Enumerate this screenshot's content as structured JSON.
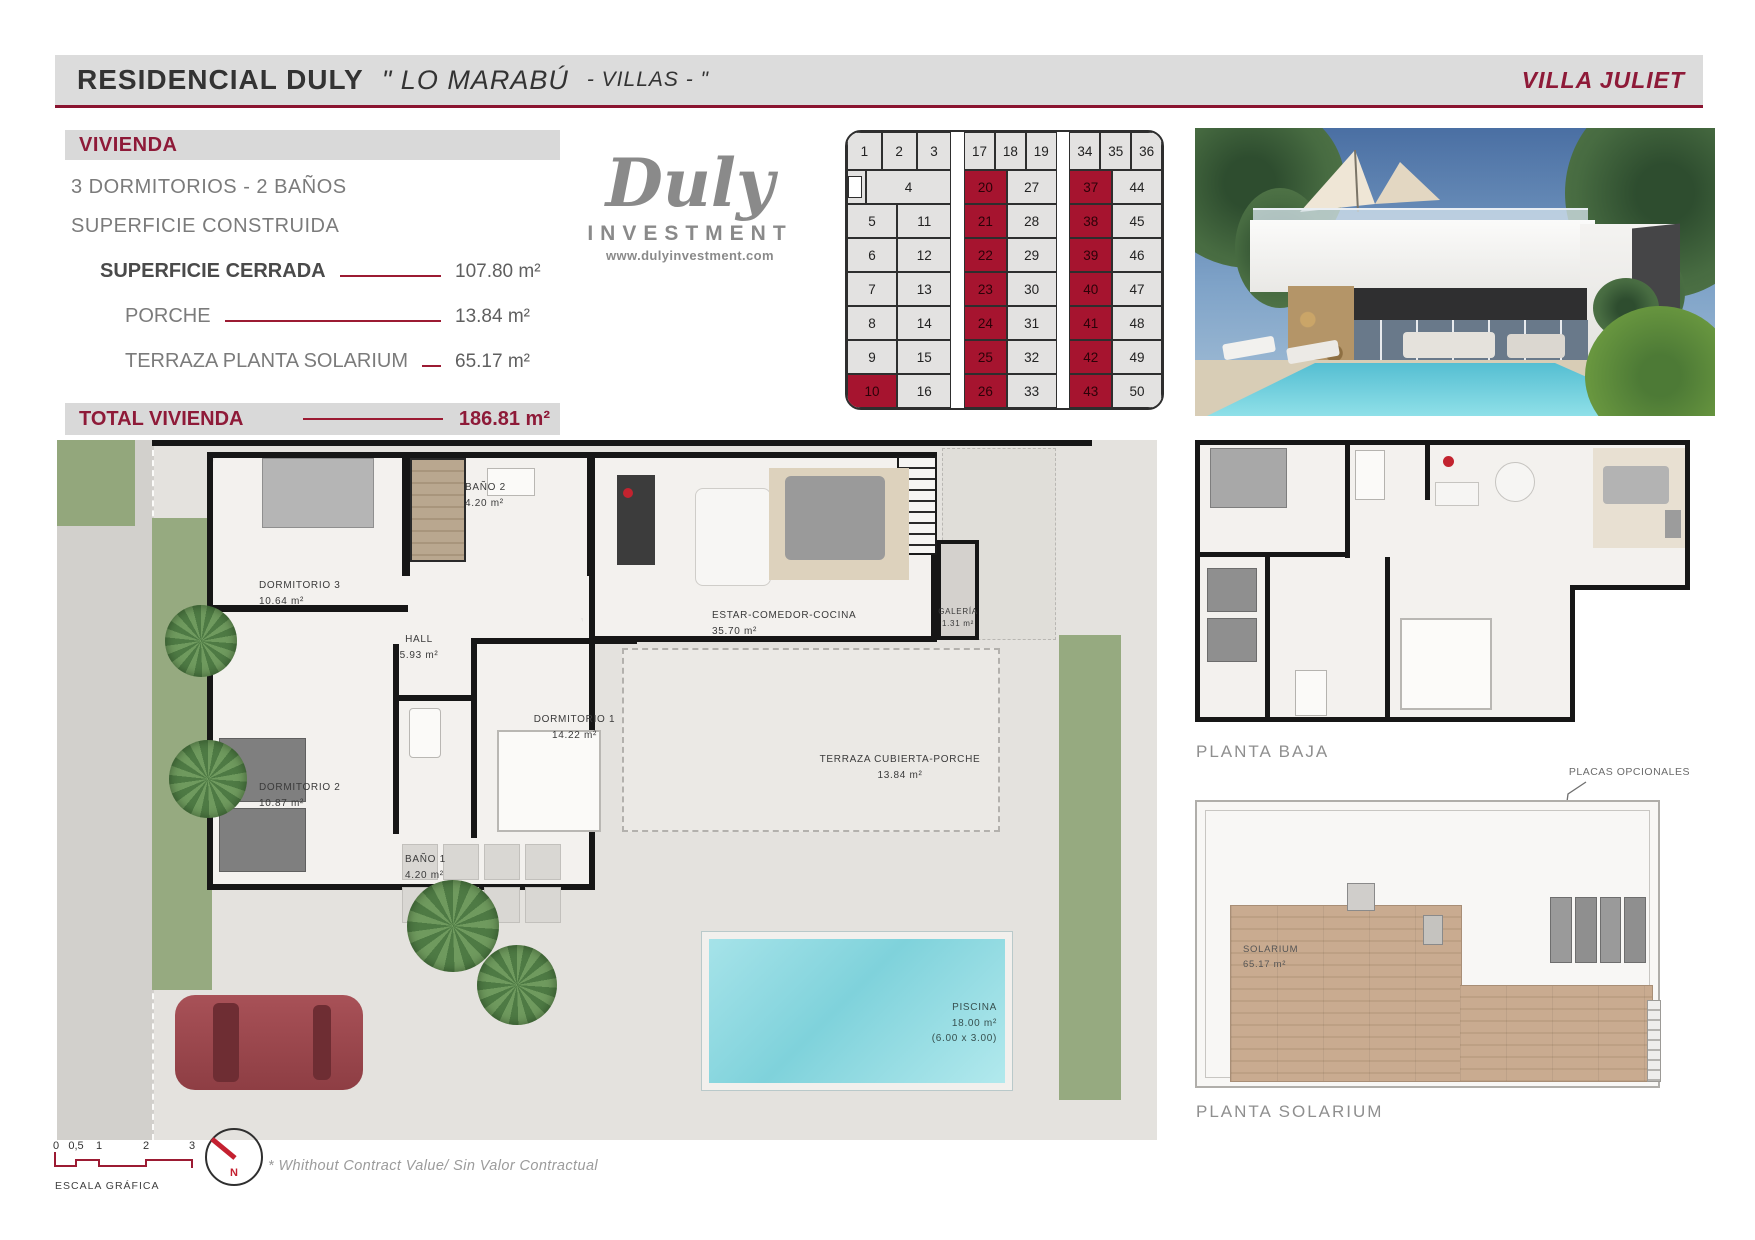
{
  "header": {
    "title": "RESIDENCIAL DULY",
    "subtitle_main": "\" LO MARABÚ",
    "subtitle_small": "- VILLAS - \"",
    "villa": "VILLA JULIET"
  },
  "specs": {
    "section_title": "VIVIENDA",
    "bedrooms_baths": "3 DORMITORIOS - 2 BAÑOS",
    "built_label": "SUPERFICIE CONSTRUIDA",
    "rows": {
      "cerrada": {
        "label": "SUPERFICIE CERRADA",
        "value": "107.80 m²"
      },
      "porche": {
        "label": "PORCHE",
        "value": "13.84 m²"
      },
      "terraza": {
        "label": "TERRAZA PLANTA SOLARIUM",
        "value": "65.17 m²"
      }
    },
    "total_label": "TOTAL VIVIENDA",
    "total_value": "186.81 m²"
  },
  "logo": {
    "name": "Duly",
    "subtitle": "INVESTMENT",
    "website": "www.dulyinvestment.com"
  },
  "plot_grid": {
    "left": {
      "top": [
        {
          "n": "1"
        },
        {
          "n": "2"
        },
        {
          "n": "3"
        }
      ],
      "wide": "4",
      "col1": [
        {
          "n": "5"
        },
        {
          "n": "6"
        },
        {
          "n": "7"
        },
        {
          "n": "8"
        },
        {
          "n": "9"
        },
        {
          "n": "10",
          "hl": true
        }
      ],
      "col2": [
        {
          "n": "11"
        },
        {
          "n": "12"
        },
        {
          "n": "13"
        },
        {
          "n": "14"
        },
        {
          "n": "15"
        },
        {
          "n": "16"
        }
      ]
    },
    "mid": {
      "top": [
        {
          "n": "17"
        },
        {
          "n": "18"
        },
        {
          "n": "19"
        }
      ],
      "col1": [
        {
          "n": "20",
          "hl": true
        },
        {
          "n": "21",
          "hl": true
        },
        {
          "n": "22",
          "hl": true
        },
        {
          "n": "23",
          "hl": true
        },
        {
          "n": "24",
          "hl": true
        },
        {
          "n": "25",
          "hl": true
        },
        {
          "n": "26",
          "hl": true
        }
      ],
      "col2": [
        {
          "n": "27"
        },
        {
          "n": "28"
        },
        {
          "n": "29"
        },
        {
          "n": "30"
        },
        {
          "n": "31"
        },
        {
          "n": "32"
        },
        {
          "n": "33"
        }
      ]
    },
    "right": {
      "top": [
        {
          "n": "34"
        },
        {
          "n": "35"
        },
        {
          "n": "36"
        }
      ],
      "col1": [
        {
          "n": "37",
          "hl": true
        },
        {
          "n": "38",
          "hl": true
        },
        {
          "n": "39",
          "hl": true
        },
        {
          "n": "40",
          "hl": true
        },
        {
          "n": "41",
          "hl": true
        },
        {
          "n": "42",
          "hl": true
        },
        {
          "n": "43",
          "hl": true
        }
      ],
      "col2": [
        {
          "n": "44"
        },
        {
          "n": "45"
        },
        {
          "n": "46"
        },
        {
          "n": "47"
        },
        {
          "n": "48"
        },
        {
          "n": "49"
        },
        {
          "n": "50"
        }
      ]
    }
  },
  "floorplan": {
    "rooms": {
      "dormitorio3": {
        "name": "DORMITORIO 3",
        "area": "10.64 m²"
      },
      "bano2": {
        "name": "BAÑO 2",
        "area": "4.20 m²"
      },
      "hall": {
        "name": "HALL",
        "area": "5.93 m²"
      },
      "estar": {
        "name": "ESTAR-COMEDOR-COCINA",
        "area": "35.70 m²"
      },
      "galeria": {
        "name": "GALERÍA",
        "area": "1.31 m²"
      },
      "dormitorio1": {
        "name": "DORMITORIO 1",
        "area": "14.22 m²"
      },
      "dormitorio2": {
        "name": "DORMITORIO 2",
        "area": "10.87 m²"
      },
      "bano1": {
        "name": "BAÑO 1",
        "area": "4.20 m²"
      },
      "terraza": {
        "name": "TERRAZA CUBIERTA-PORCHE",
        "area": "13.84 m²"
      },
      "piscina": {
        "name": "PISCINA",
        "area": "18.00 m²",
        "dims": "(6.00 x 3.00)"
      }
    }
  },
  "plans": {
    "planta_baja": "PLANTA BAJA",
    "planta_solarium": "PLANTA SOLARIUM",
    "placas": "PLACAS OPCIONALES",
    "solarium": {
      "name": "SOLARIUM",
      "area": "65.17 m²"
    }
  },
  "footer": {
    "scale_ticks": [
      "0",
      "0,5",
      "1",
      "2",
      "3"
    ],
    "scale_label": "ESCALA GRÁFICA",
    "north": "N",
    "note": "*  Whithout Contract Value/ Sin Valor Contractual"
  }
}
